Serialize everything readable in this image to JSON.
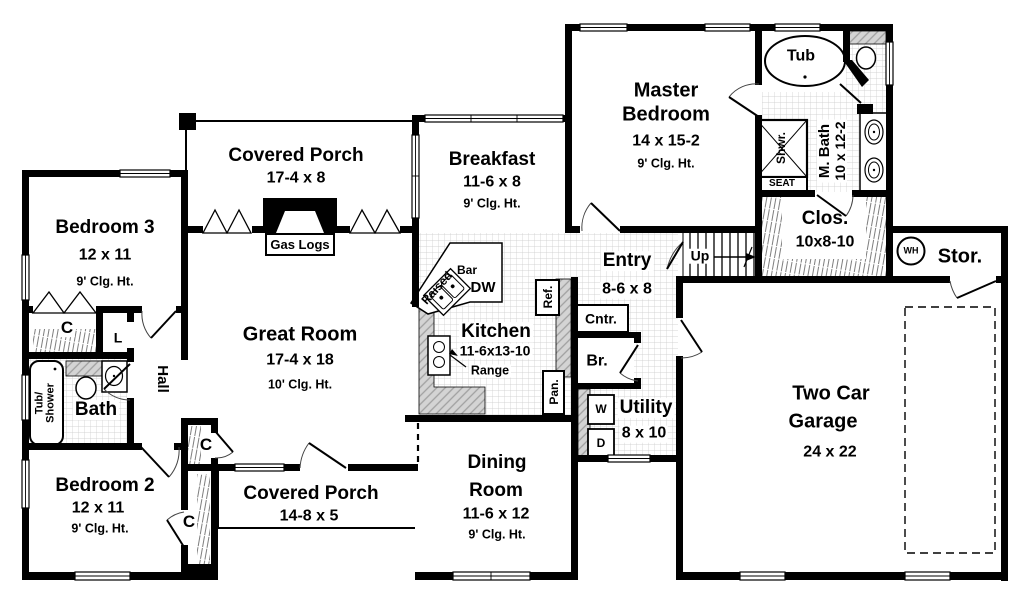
{
  "rooms": {
    "bedroom3": {
      "name": "Bedroom 3",
      "dims": "12 x 11",
      "ceiling": "9' Clg. Ht."
    },
    "bedroom2": {
      "name": "Bedroom 2",
      "dims": "12 x 11",
      "ceiling": "9' Clg. Ht."
    },
    "great_room": {
      "name": "Great Room",
      "dims": "17-4 x 18",
      "ceiling": "10' Clg. Ht."
    },
    "porch_rear": {
      "name": "Covered Porch",
      "dims": "17-4 x 8"
    },
    "porch_front": {
      "name": "Covered Porch",
      "dims": "14-8 x 5"
    },
    "breakfast": {
      "name": "Breakfast",
      "dims": "11-6 x 8",
      "ceiling": "9' Clg. Ht."
    },
    "master_bedroom": {
      "line1": "Master",
      "line2": "Bedroom",
      "dims": "14 x 15-2",
      "ceiling": "9' Clg. Ht."
    },
    "master_bath": {
      "name": "M. Bath",
      "dims": "10 x 12-2"
    },
    "closet_master": {
      "name": "Clos.",
      "dims": "10x8-10"
    },
    "storage": {
      "name": "Stor."
    },
    "entry": {
      "name": "Entry",
      "dims": "8-6 x 8"
    },
    "kitchen": {
      "name": "Kitchen",
      "dims": "11-6x13-10"
    },
    "dining": {
      "line1": "Dining",
      "line2": "Room",
      "dims": "11-6 x 12",
      "ceiling": "9' Clg. Ht."
    },
    "utility": {
      "name": "Utility",
      "dims": "8 x 10"
    },
    "garage": {
      "line1": "Two Car",
      "line2": "Garage",
      "dims": "24 x 22"
    },
    "bath": {
      "name": "Bath"
    },
    "hall": {
      "name": "Hall"
    },
    "broom_closet": {
      "name": "Br."
    }
  },
  "fixtures": {
    "tub": "Tub",
    "shower": "Shwr.",
    "seat": "SEAT",
    "tub_shower_line1": "Tub/",
    "tub_shower_line2": "Shower",
    "gas_logs": "Gas Logs",
    "dishwasher": "DW",
    "bar": "Bar",
    "raised": "Raised",
    "range": "Range",
    "refrigerator": "Ref.",
    "pantry": "Pan.",
    "counter": "Cntr.",
    "washer": "W",
    "dryer": "D",
    "water_heater": "WH",
    "stairs_up": "Up",
    "closet_c": "C",
    "linen_l": "L"
  }
}
